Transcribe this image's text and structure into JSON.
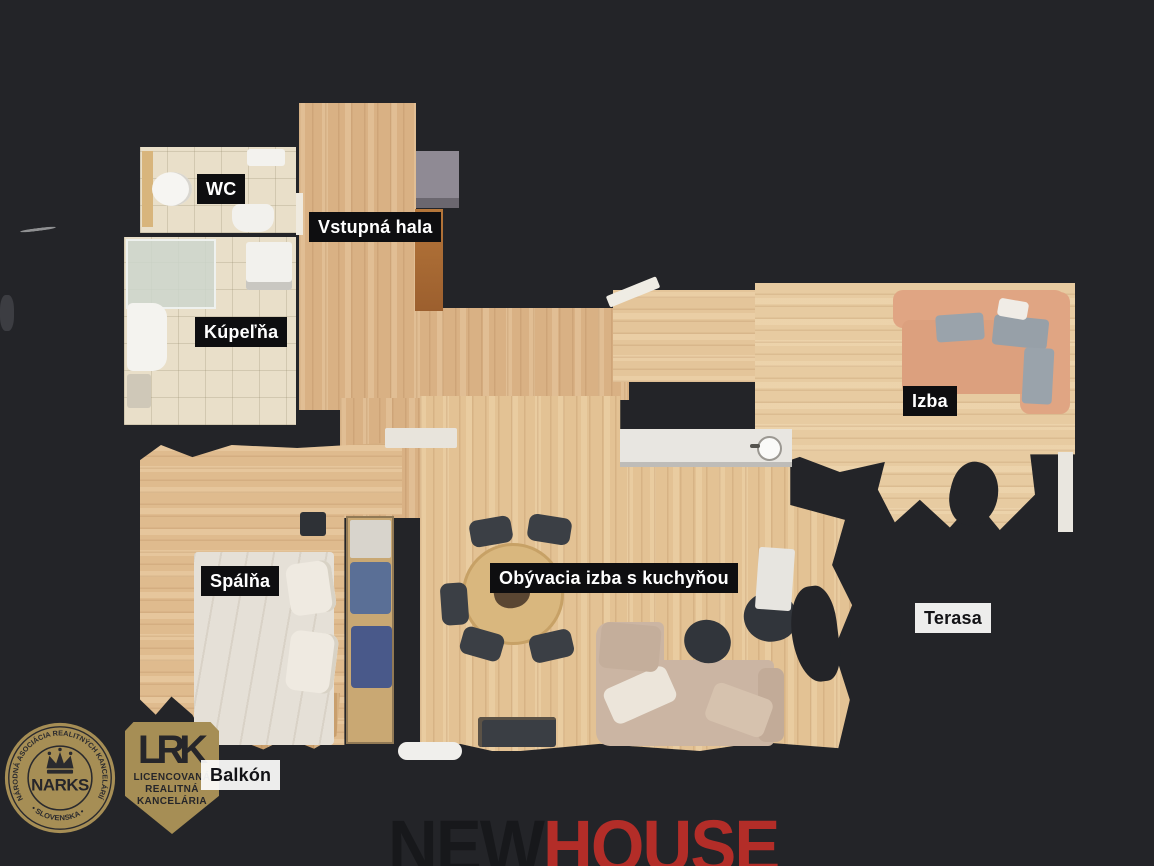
{
  "page": {
    "background_color": "#232428",
    "type": "real-estate floor plan"
  },
  "floor_plan": {
    "rooms": [
      {
        "id": "wc",
        "label": "WC",
        "label_style": "dark"
      },
      {
        "id": "vstupna-hala",
        "label": "Vstupná hala",
        "label_style": "dark"
      },
      {
        "id": "kupelna",
        "label": "Kúpeľňa",
        "label_style": "dark"
      },
      {
        "id": "izba",
        "label": "Izba",
        "label_style": "dark"
      },
      {
        "id": "spalna",
        "label": "Spálňa",
        "label_style": "dark"
      },
      {
        "id": "obyvacia-izba",
        "label": "Obývacia izba s kuchyňou",
        "label_style": "dark"
      },
      {
        "id": "terasa",
        "label": "Terasa",
        "label_style": "light"
      },
      {
        "id": "balkon",
        "label": "Balkón",
        "label_style": "light"
      }
    ],
    "label_colors": {
      "dark_bg": "#0e0e10",
      "dark_text": "#ffffff",
      "light_bg": "#fdfdfc",
      "light_text": "#131316"
    }
  },
  "branding": {
    "narks_badge": {
      "arc_top": "NÁRODNÁ ASOCIÁCIA REALITNÝCH KANCELÁRIÍ",
      "arc_bottom": "• SLOVENSKA •",
      "center": "NARKS",
      "gold": "#a68e55",
      "ink": "#26262a"
    },
    "lrk_badge": {
      "abbr": "LRK",
      "line1": "LICENCOVANÁ",
      "line2": "REALITNÁ",
      "line3": "KANCELÁRIA",
      "gold": "#a68e55",
      "ink": "#26262a"
    },
    "agency_logo": {
      "part1": "NEW",
      "part2": "HOUSE",
      "part1_color": "#17181b",
      "part2_color": "#b32d28"
    }
  }
}
